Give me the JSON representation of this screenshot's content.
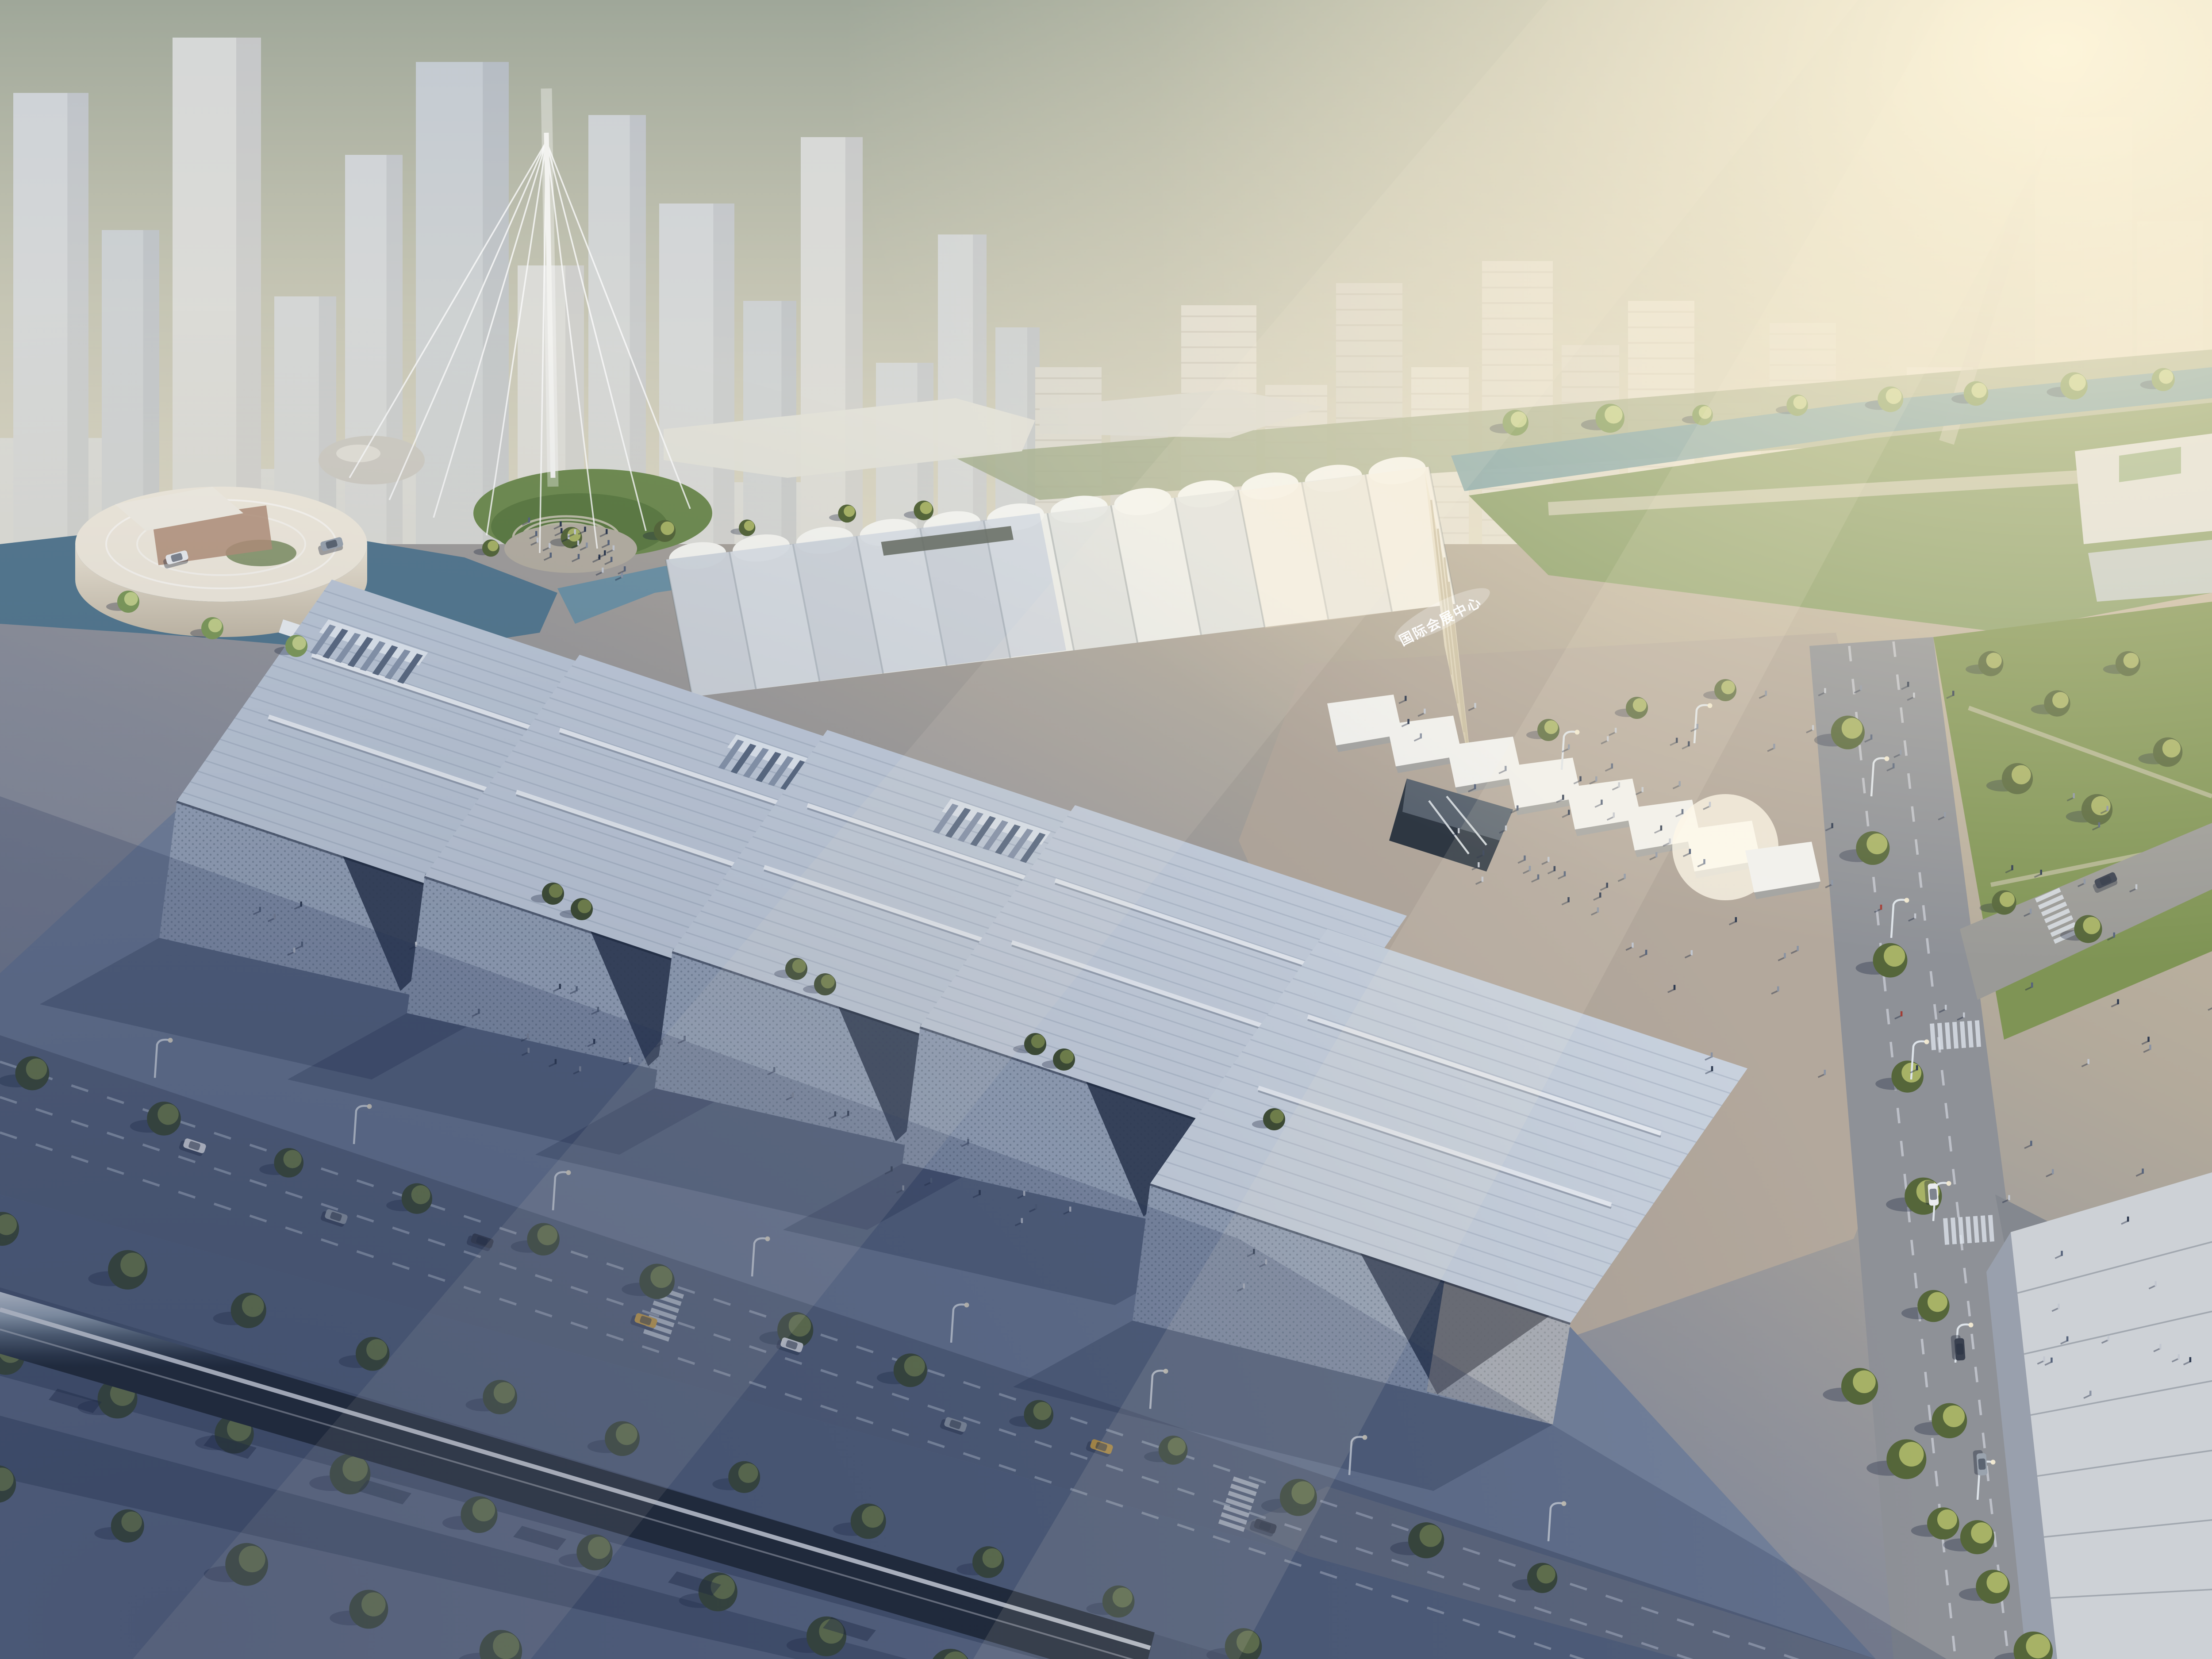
{
  "scene": {
    "title": "Aerial rendering of an international convention and exhibition center at hazy sunrise",
    "building_sign": {
      "text": "国际会展中心"
    },
    "counts": {
      "exhibition_halls": 5,
      "wave_roof_bays": 12,
      "canopy_modules": 8,
      "mast_cables": 8,
      "roof_monitors": 3
    },
    "palette": {
      "skyTop": "#9fa799",
      "skyHorizon": "#ddd5bc",
      "sunGlow": "#fff3d6",
      "towerLight": "#ccd1d7",
      "towerWarm": "#d3d2cc",
      "field": "#a9b192",
      "lawn": "#7f9455",
      "water": "#54788f",
      "canal": "#7fa3a8",
      "plaza": "#b3a89c",
      "pavingCool": "#72809a",
      "asphalt": "#5b6880",
      "roadSun": "#8e9197",
      "roadMark": "#d7dfea",
      "waveRoof": "#efefe9",
      "endWall": "#e9e1cc",
      "hallRoof": "#bcc7d6",
      "hallFacade": "#94a1b6",
      "entranceDark": "#2c3850",
      "canopy": "#f1f1ee",
      "pitDark": "#2e3742",
      "treeDark": "#3e4c32",
      "treeLit": "#55663a",
      "treeHighlight": "#a7b266",
      "willow": "#7e9a5a",
      "monorailLight": "#eef3f7",
      "monorailDark": "#2e3844",
      "cornerRoof": "#cdd1d6",
      "cornerSide": "#99a0ad",
      "carWhite": "#e9ebee",
      "carGray": "#9aa3ae",
      "carDark": "#3a4150",
      "carYellow": "#d9a83f",
      "sign": "#ffffff"
    },
    "people_colors": [
      "#2e3a50",
      "#57647c",
      "#c2c7d0",
      "#8a93a3",
      "#a23d35"
    ]
  }
}
